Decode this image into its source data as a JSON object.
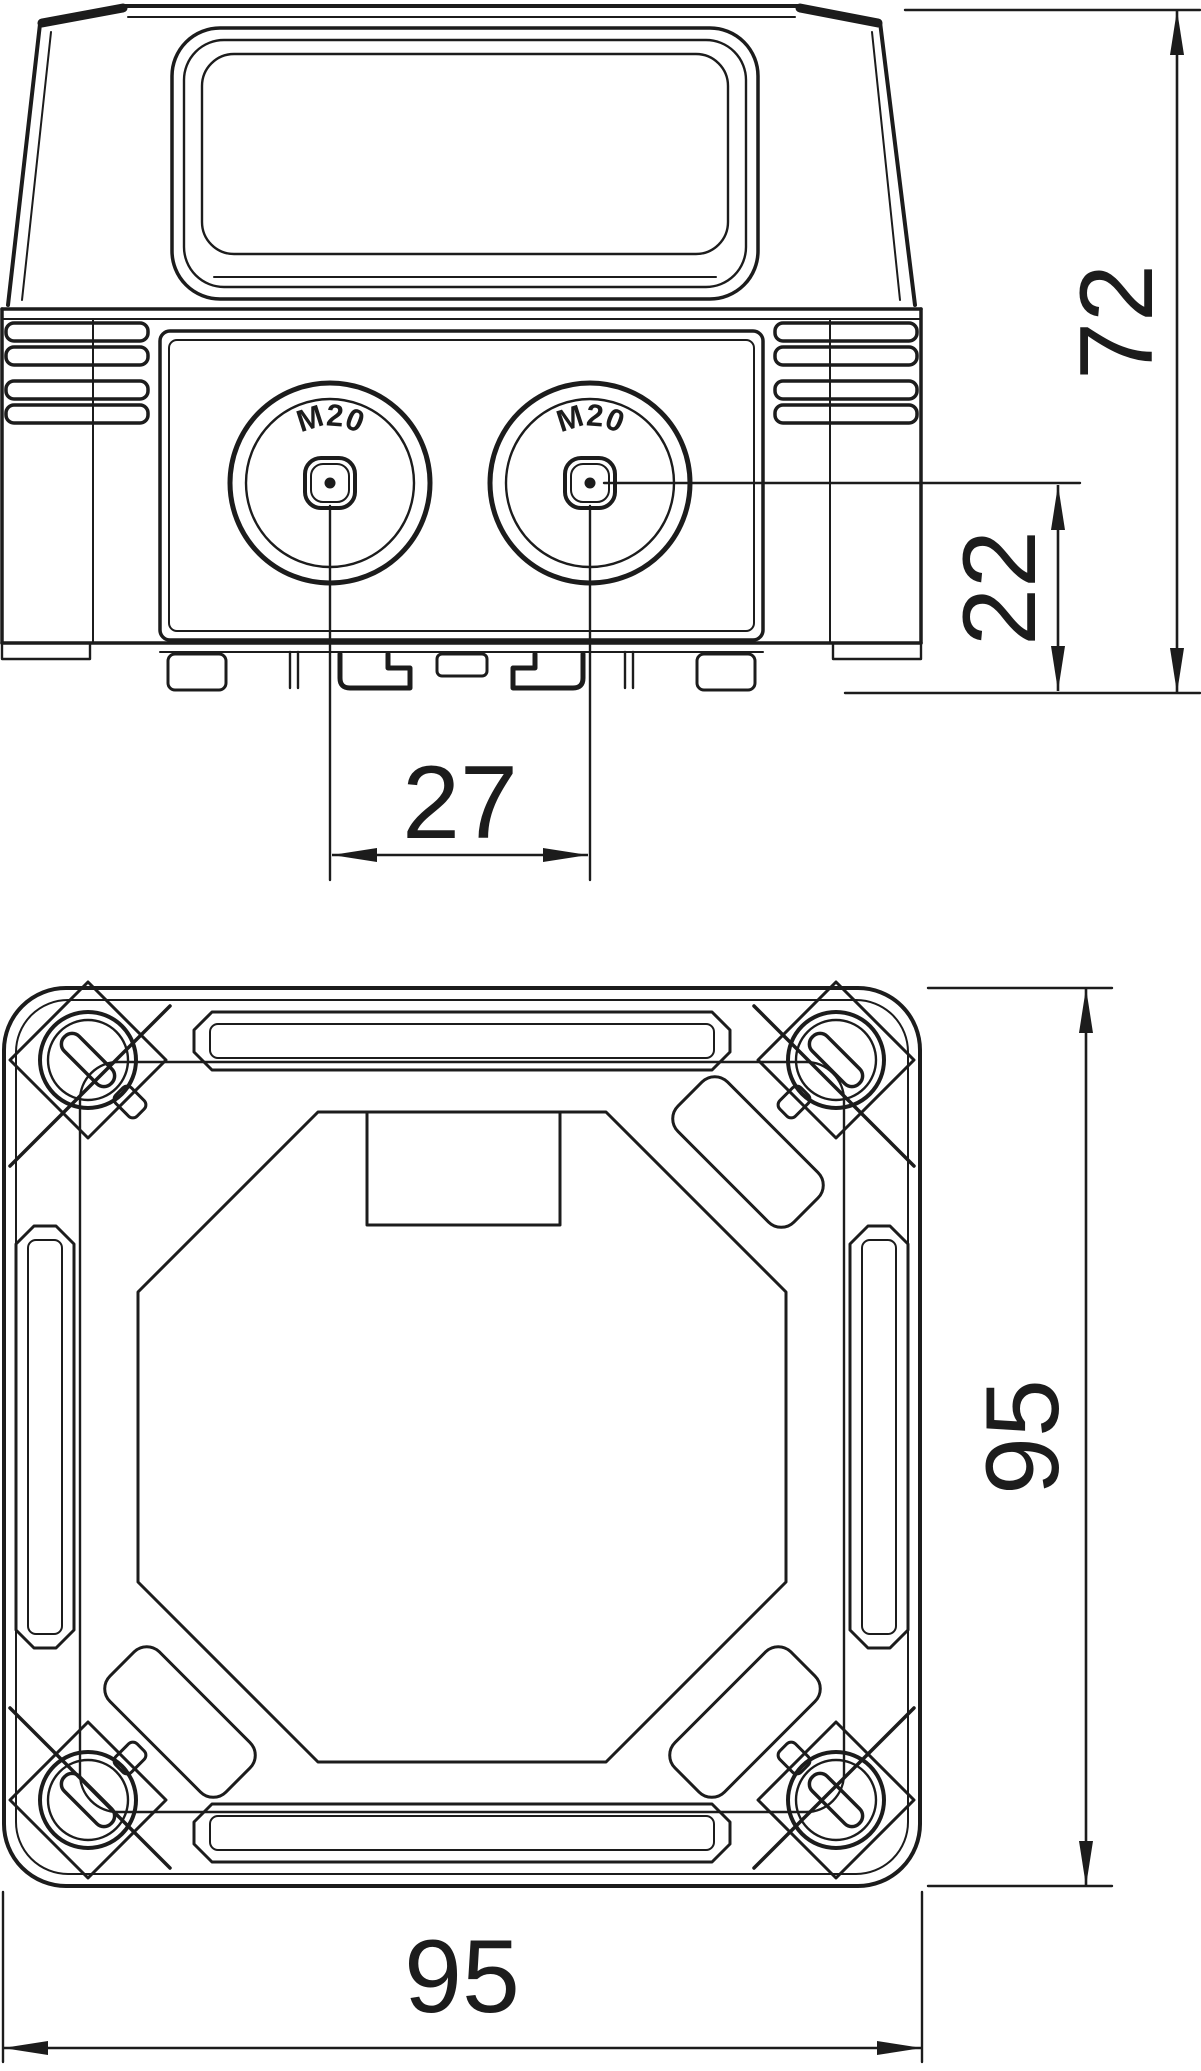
{
  "front_view": {
    "knockouts": {
      "left_label": "M20",
      "right_label": "M20"
    },
    "dims": {
      "total_height": "72",
      "center_to_bottom": "22",
      "knockout_spacing": "27"
    }
  },
  "bottom_view": {
    "dims": {
      "height": "95",
      "width": "95"
    }
  },
  "colors": {
    "line": "#1c1c1c",
    "background": "#ffffff"
  }
}
